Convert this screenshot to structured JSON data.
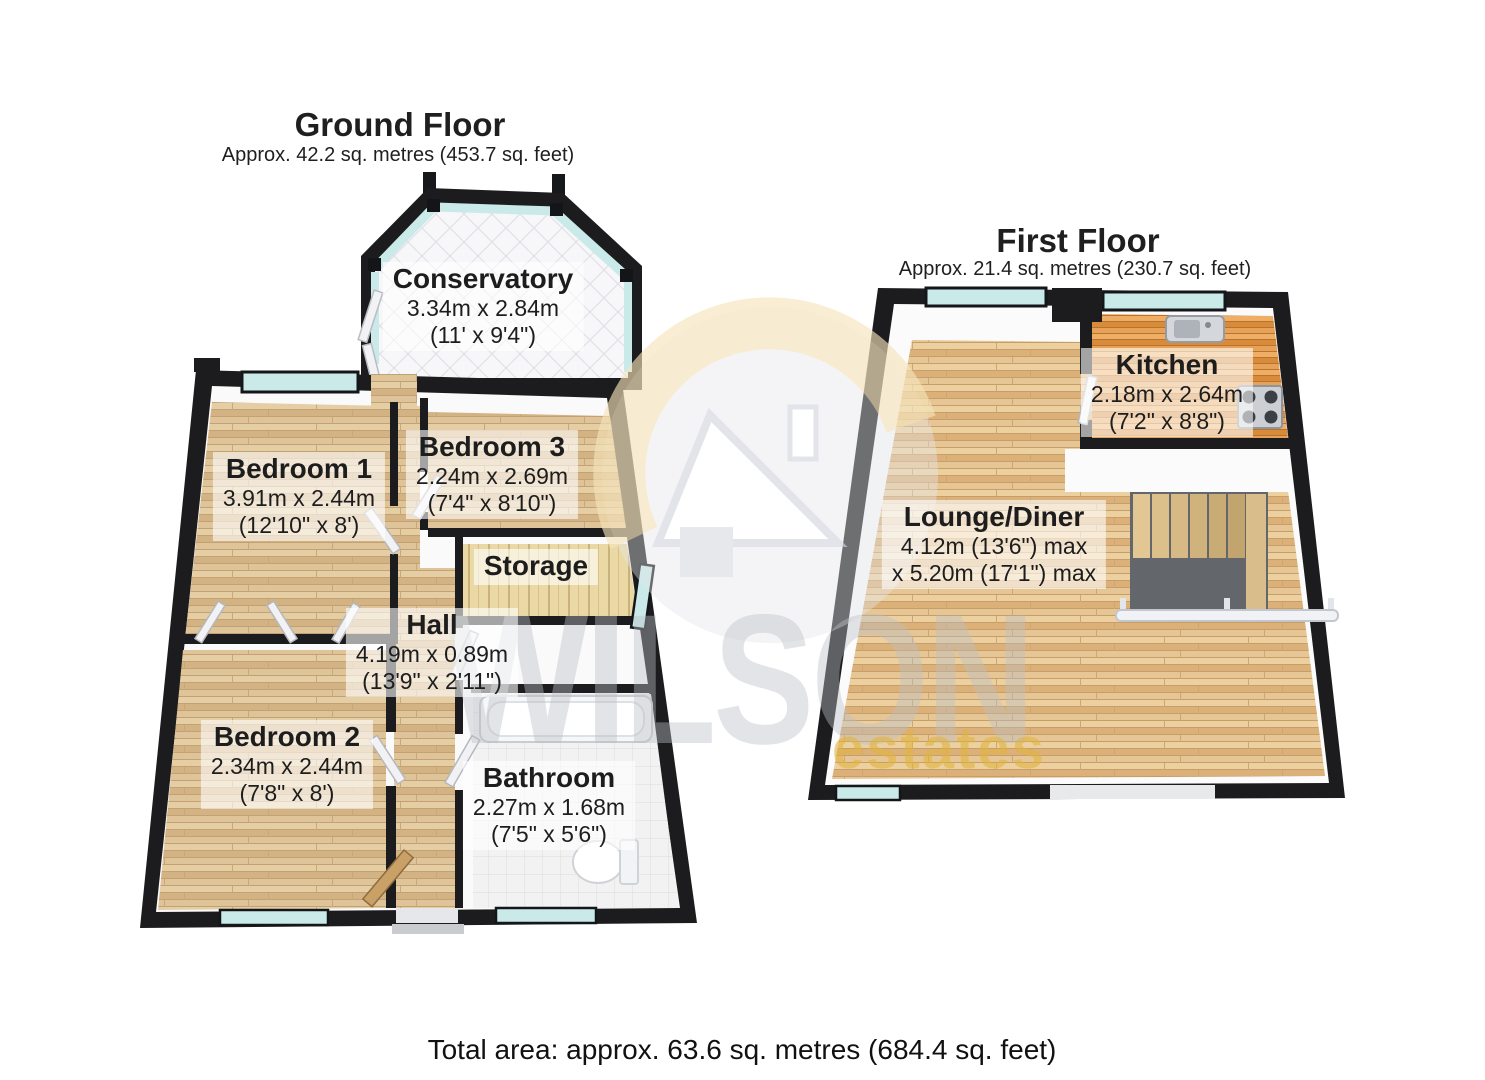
{
  "page": {
    "background": "#ffffff",
    "total_area": "Total area: approx. 63.6 sq. metres (684.4 sq. feet)"
  },
  "watermark": {
    "brand": "WILSON",
    "brand_sub": "estates",
    "logo": "house-in-circle-icon",
    "brand_color": "#babec6",
    "accent_color": "#e0b43c"
  },
  "ground_floor": {
    "title": "Ground Floor",
    "area": "Approx. 42.2 sq. metres (453.7 sq. feet)",
    "rooms": {
      "conservatory": {
        "name": "Conservatory",
        "dims": [
          "3.34m x 2.84m",
          "(11' x 9'4\")"
        ]
      },
      "bedroom1": {
        "name": "Bedroom 1",
        "dims": [
          "3.91m x 2.44m",
          "(12'10\" x 8')"
        ]
      },
      "bedroom3": {
        "name": "Bedroom 3",
        "dims": [
          "2.24m x 2.69m",
          "(7'4\" x 8'10\")"
        ]
      },
      "storage": {
        "name": "Storage",
        "dims": []
      },
      "hall": {
        "name": "Hall",
        "dims": [
          "4.19m x 0.89m",
          "(13'9\" x 2'11\")"
        ]
      },
      "bedroom2": {
        "name": "Bedroom 2",
        "dims": [
          "2.34m x 2.44m",
          "(7'8\" x 8')"
        ]
      },
      "bathroom": {
        "name": "Bathroom",
        "dims": [
          "2.27m x 1.68m",
          "(7'5\" x 5'6\")"
        ]
      }
    }
  },
  "first_floor": {
    "title": "First Floor",
    "area": "Approx. 21.4 sq. metres (230.7 sq. feet)",
    "rooms": {
      "kitchen": {
        "name": "Kitchen",
        "dims": [
          "2.18m x 2.64m",
          "(7'2\" x 8'8\")"
        ]
      },
      "lounge": {
        "name": "Lounge/Diner",
        "dims": [
          "4.12m (13'6\") max",
          "x 5.20m (17'1\") max"
        ]
      }
    }
  }
}
